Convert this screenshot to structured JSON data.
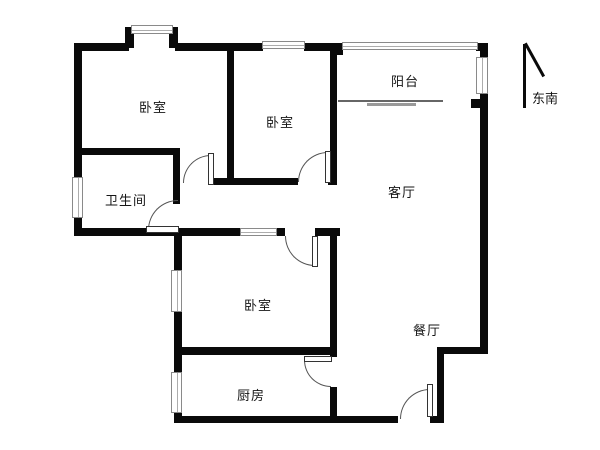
{
  "rooms": [
    {
      "id": "bedroom-1",
      "label": "卧室"
    },
    {
      "id": "bedroom-2",
      "label": "卧室"
    },
    {
      "id": "balcony",
      "label": "阳台"
    },
    {
      "id": "living-room",
      "label": "客厅"
    },
    {
      "id": "bathroom",
      "label": "卫生间"
    },
    {
      "id": "bedroom-3",
      "label": "卧室"
    },
    {
      "id": "kitchen",
      "label": "厨房"
    },
    {
      "id": "dining-room",
      "label": "餐厅"
    }
  ],
  "compass": {
    "label": "东南"
  },
  "colors": {
    "wall": "#0a0a0a",
    "background": "#ffffff",
    "window_frame": "#8a8a8a",
    "door_arc": "#555555"
  }
}
